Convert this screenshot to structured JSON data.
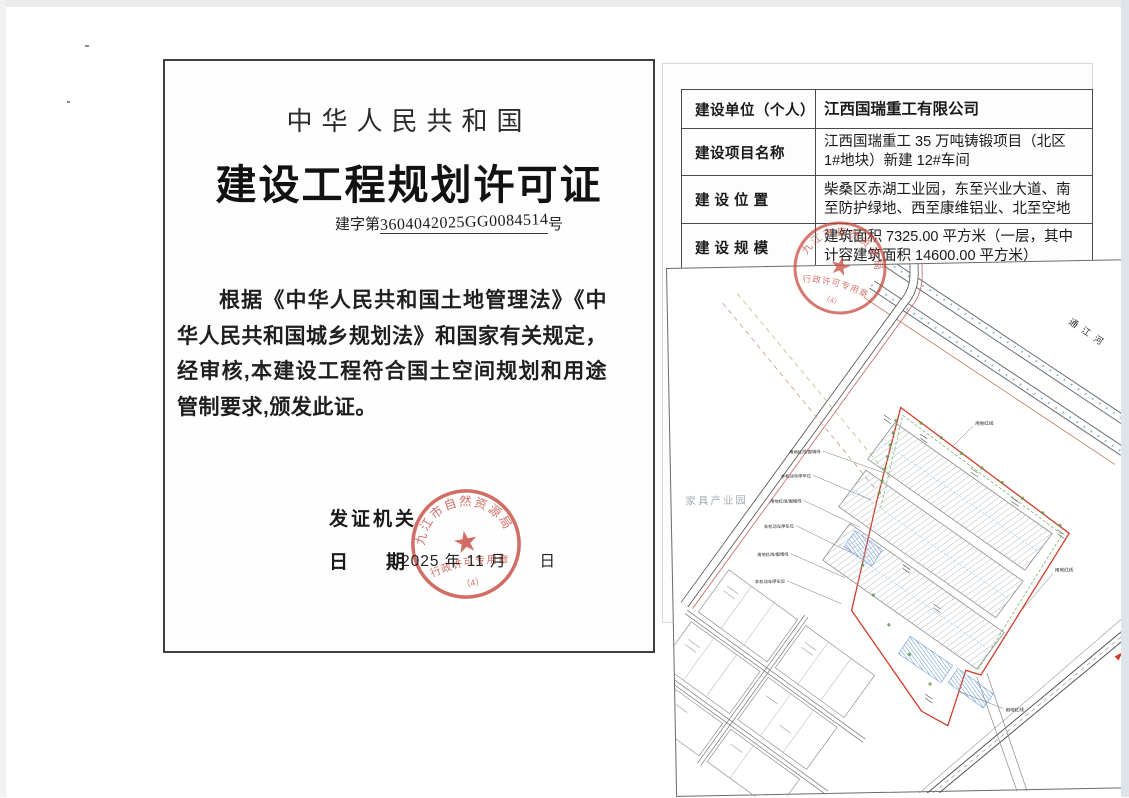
{
  "page_left": {
    "heading_country": "中华人民共和国",
    "title": "建设工程规划许可证",
    "cert_prefix": "建字第",
    "cert_number": "3604042025GG0084514",
    "cert_suffix": "号",
    "body_text": "根据《中华人民共和国土地管理法》《中华人民共和国城乡规划法》和国家有关规定，经审核,本建设工程符合国土空间规划和用途管制要求,颁发此证。",
    "issuer_label": "发证机关",
    "date_label": "日　　期",
    "date_value": "2025 年 11 月　　日"
  },
  "seal": {
    "org": "九江市自然资源局",
    "purpose": "行政许可专用章",
    "index": "（4）",
    "color": "#c5453a"
  },
  "info_table": {
    "rows": [
      {
        "label": "建设单位（个人）",
        "value": "江西国瑞重工有限公司"
      },
      {
        "label": "建设项目名称",
        "value": "江西国瑞重工 35 万吨铸锻项目（北区 1#地块）新建 12#车间"
      },
      {
        "label": "建 设 位 置",
        "value": "柴桑区赤湖工业园，东至兴业大道、南至防护绿地、西至康维铝业、北至空地"
      },
      {
        "label": "建 设 规 模",
        "value": "建筑面积 7325.00 平方米（一层，其中计容建筑面积 14600.00 平方米）"
      },
      {
        "label": "附图及附件名称",
        "value": ""
      }
    ]
  },
  "site_plan": {
    "river_label": "通江河",
    "adjacent_area_label": "家具产业园",
    "red_line_label": "用地红线",
    "red_line_wall_label": "用地红线/围墙线",
    "parking_label": "非机动车停车位"
  }
}
